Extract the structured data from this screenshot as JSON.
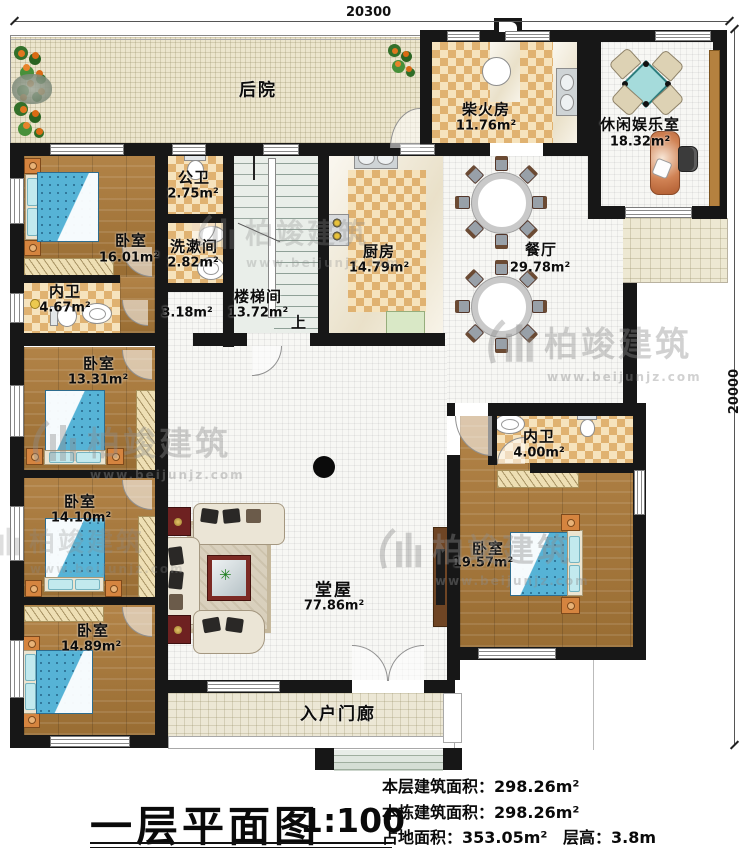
{
  "dimensions": {
    "top": "20300",
    "right": "20000"
  },
  "rooms": {
    "backyard": {
      "name": "后院"
    },
    "firewood": {
      "name": "柴火房",
      "area": "11.76m²"
    },
    "leisure": {
      "name": "休闲娱乐室",
      "area": "18.32m²"
    },
    "public_bath": {
      "name": "公卫",
      "area": "2.75m²"
    },
    "washroom": {
      "name": "洗漱间",
      "area": "2.82m²"
    },
    "stairwell": {
      "name": "楼梯间",
      "area": "13.72m²",
      "up_label": "上"
    },
    "corridor": {
      "area": "3.18m²"
    },
    "kitchen": {
      "name": "厨房",
      "area": "14.79m²"
    },
    "dining": {
      "name": "餐厅",
      "area": "29.78m²"
    },
    "bedroom1": {
      "name": "卧室",
      "area": "16.01m²"
    },
    "ensuite_left": {
      "name": "内卫",
      "area": "4.67m²"
    },
    "bedroom2": {
      "name": "卧室",
      "area": "13.31m²"
    },
    "bedroom3": {
      "name": "卧室",
      "area": "14.10m²"
    },
    "bedroom4": {
      "name": "卧室",
      "area": "14.89m²"
    },
    "ensuite_right": {
      "name": "内卫",
      "area": "4.00m²"
    },
    "bedroom5": {
      "name": "卧室",
      "area": "19.57m²"
    },
    "hall": {
      "name": "堂屋",
      "area": "77.86m²"
    },
    "porch": {
      "name": "入户门廊"
    }
  },
  "watermark": {
    "brand": "柏竣建筑",
    "url": "www.beijunjz.com"
  },
  "titleblock": {
    "title": "一层平面图",
    "scale": "1:100"
  },
  "stats": {
    "floor_area_label": "本层建筑面积：",
    "floor_area": "298.26m²",
    "building_area_label": "本栋建筑面积：",
    "building_area": "298.26m²",
    "land_area_label": "占地面积：",
    "land_area": "353.05m²",
    "height_label": "层高：",
    "height": "3.8m"
  }
}
